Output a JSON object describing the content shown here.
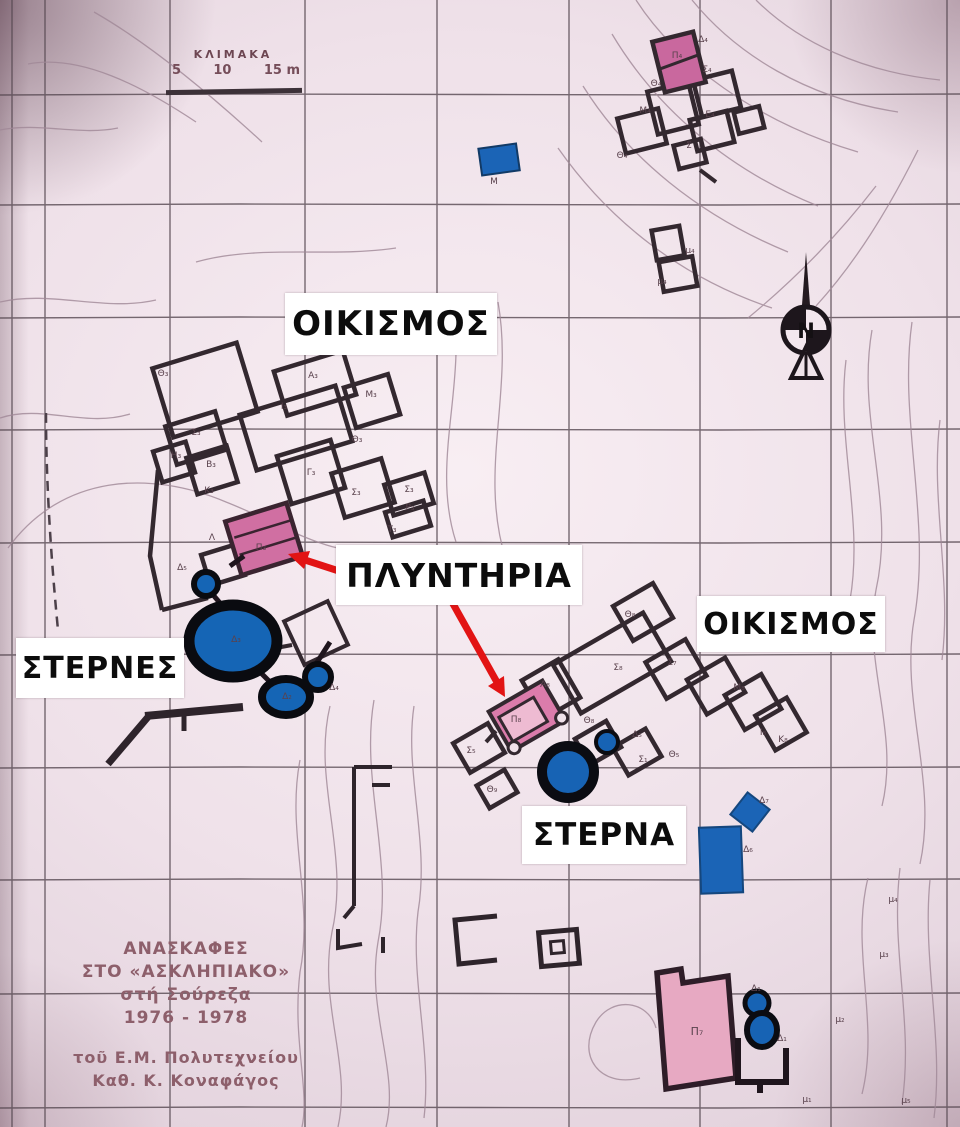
{
  "map_labels": {
    "settlement_top": "ΟΙΚΙΣΜΟΣ",
    "washeries": "ΠΛΥΝΤΗΡΙΑ",
    "cisterns": "ΣΤΕΡΝΕΣ",
    "settlement_right": "ΟΙΚΙΣΜΟΣ",
    "cistern": "ΣΤΕΡΝΑ"
  },
  "scale": {
    "title": "ΚΛΙΜΑΚΑ",
    "ticks": [
      "5",
      "10",
      "15 m"
    ]
  },
  "credits": {
    "lines": [
      "ΑΝΑΣΚΑΦΕΣ",
      "ΣΤΟ «ΑΣΚΛΗΠΙΑΚΟ»",
      "στή Σούρεζα",
      "1976 - 1978",
      "τοῦ Ε.Μ. Πολυτεχνείου",
      "Καθ. Κ. Κοναφάγος"
    ]
  },
  "north": {
    "letter": "N"
  },
  "colors": {
    "paper": "#efe1e9",
    "wall": "#33282f",
    "washery_pink": "#d06fa2",
    "building_pink": "#e7a9c2",
    "cistern_blue": "#1565b5",
    "arrow_red": "#e21414",
    "label_bg": "#ffffff",
    "label_text": "#0c0c0c",
    "print_text": "#8d5f6b"
  },
  "room_labels": [
    {
      "t": "Θ₃",
      "x": 163,
      "y": 376
    },
    {
      "t": "Α₃",
      "x": 313,
      "y": 378
    },
    {
      "t": "Μ₃",
      "x": 371,
      "y": 397
    },
    {
      "t": "Ι₃",
      "x": 284,
      "y": 409
    },
    {
      "t": "Θ₃",
      "x": 357,
      "y": 442
    },
    {
      "t": "Σ₃",
      "x": 196,
      "y": 435
    },
    {
      "t": "Η₃",
      "x": 176,
      "y": 458
    },
    {
      "t": "Β₃",
      "x": 211,
      "y": 467
    },
    {
      "t": "Γ₃",
      "x": 311,
      "y": 475
    },
    {
      "t": "Σ₃",
      "x": 356,
      "y": 495
    },
    {
      "t": "Κ₃",
      "x": 209,
      "y": 493
    },
    {
      "t": "Σ₃",
      "x": 409,
      "y": 492
    },
    {
      "t": "Ρ₃",
      "x": 410,
      "y": 510
    },
    {
      "t": "Π₃",
      "x": 261,
      "y": 550
    },
    {
      "t": "Λ",
      "x": 212,
      "y": 540
    },
    {
      "t": "Τ₃",
      "x": 392,
      "y": 532
    },
    {
      "t": "Δ₅",
      "x": 182,
      "y": 570
    },
    {
      "t": "Δ₄",
      "x": 334,
      "y": 690
    },
    {
      "t": "Δ₂",
      "x": 287,
      "y": 699
    },
    {
      "t": "Δ₃",
      "x": 236,
      "y": 642
    },
    {
      "t": "Θ₈",
      "x": 630,
      "y": 617
    },
    {
      "t": "Σ₈",
      "x": 618,
      "y": 670
    },
    {
      "t": "Σ₇",
      "x": 672,
      "y": 665
    },
    {
      "t": "Α₈",
      "x": 545,
      "y": 687
    },
    {
      "t": "Μ₈",
      "x": 739,
      "y": 690
    },
    {
      "t": "Θ₈",
      "x": 589,
      "y": 723
    },
    {
      "t": "Π₈",
      "x": 516,
      "y": 722
    },
    {
      "t": "Ι₈",
      "x": 763,
      "y": 735
    },
    {
      "t": "Κ₈",
      "x": 783,
      "y": 742
    },
    {
      "t": "Δ₅",
      "x": 637,
      "y": 737
    },
    {
      "t": "Θ₅",
      "x": 674,
      "y": 757
    },
    {
      "t": "Σ₁",
      "x": 643,
      "y": 762
    },
    {
      "t": "Σ₅",
      "x": 471,
      "y": 753
    },
    {
      "t": "Θ₉",
      "x": 492,
      "y": 792
    },
    {
      "t": "Π₄",
      "x": 677,
      "y": 58
    },
    {
      "t": "Δ₄",
      "x": 703,
      "y": 42
    },
    {
      "t": "Θ₄",
      "x": 656,
      "y": 86
    },
    {
      "t": "Σ₄",
      "x": 707,
      "y": 72
    },
    {
      "t": "Μ₄",
      "x": 645,
      "y": 113
    },
    {
      "t": "Ε₄",
      "x": 710,
      "y": 117
    },
    {
      "t": "Σ",
      "x": 689,
      "y": 148
    },
    {
      "t": "Θ₄",
      "x": 622,
      "y": 158
    },
    {
      "t": "μ₄",
      "x": 690,
      "y": 253
    },
    {
      "t": "μ₄",
      "x": 662,
      "y": 284
    },
    {
      "t": "Μ",
      "x": 494,
      "y": 184
    },
    {
      "t": "Δ₇",
      "x": 764,
      "y": 803
    },
    {
      "t": "Δ₆",
      "x": 748,
      "y": 852
    },
    {
      "t": "Δ₁",
      "x": 756,
      "y": 991
    },
    {
      "t": "Δ₁",
      "x": 782,
      "y": 1041
    },
    {
      "t": "Π₇",
      "x": 697,
      "y": 1035,
      "s": 11
    },
    {
      "t": "μ₄",
      "x": 893,
      "y": 902
    },
    {
      "t": "μ₃",
      "x": 884,
      "y": 957
    },
    {
      "t": "μ₂",
      "x": 840,
      "y": 1022
    },
    {
      "t": "μ₁",
      "x": 807,
      "y": 1102
    },
    {
      "t": "μ₅",
      "x": 906,
      "y": 1103
    }
  ]
}
